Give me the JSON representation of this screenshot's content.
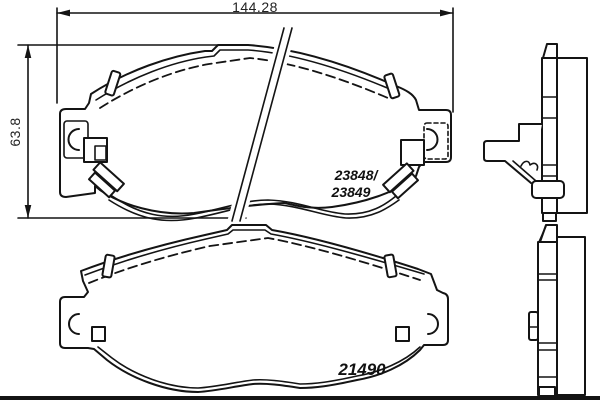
{
  "title": "Brake pad set technical drawing",
  "dimensions": {
    "width": "144.28",
    "height": "63.8"
  },
  "part_numbers": {
    "top_line1": "23848/",
    "top_line2": "23849",
    "bottom": "21490"
  },
  "colors": {
    "line": "#141414",
    "background": "#ffffff"
  }
}
